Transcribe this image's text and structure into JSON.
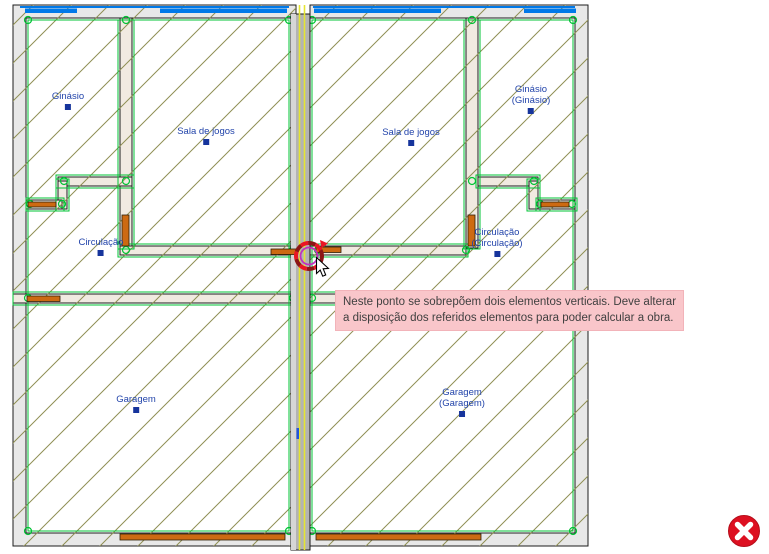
{
  "app": {
    "canvas_background": "#ffffff",
    "view": "floor-plan-editor"
  },
  "rooms": {
    "ginasio_left": {
      "label": "Ginásio"
    },
    "sala_left": {
      "label": "Sala de jogos"
    },
    "circulacao_left": {
      "label": "Circulação"
    },
    "garagem_left": {
      "label": "Garagem"
    },
    "sala_right": {
      "label": "Sala de jogos"
    },
    "ginasio_right": {
      "line1": "Ginásio",
      "line2": "(Ginásio)"
    },
    "circulacao_right": {
      "line1": "Circulação",
      "line2": "(Circulação)"
    },
    "garagem_right": {
      "line1": "Garagem",
      "line2": "(Garagem)"
    }
  },
  "tooltip": {
    "line1": "Neste ponto se sobrepõem dois elementos verticais. Deve alterar",
    "line2": "a disposição dos referidos elementos para poder calcular a obra.",
    "background": "#f9c6ca"
  },
  "markers": {
    "conflict_point": {
      "x": 309,
      "y": 256
    }
  },
  "colors": {
    "hatch_olive": "#8f8f55",
    "wall_gray": "#e8e8e8",
    "partition_beige": "#f1eae1",
    "outline_green": "#00c334",
    "window_blue": "#0079e8",
    "door_orange": "#cd6a12",
    "party_wall_gray": "#b3b3b3",
    "party_wall_yellow": "#e4e432",
    "label_blue": "#2244aa",
    "conflict_red": "#ea1525",
    "conflict_dark_red": "#8c1616",
    "conflict_magenta": "#c032c0",
    "error_badge_red": "#dd1021"
  }
}
